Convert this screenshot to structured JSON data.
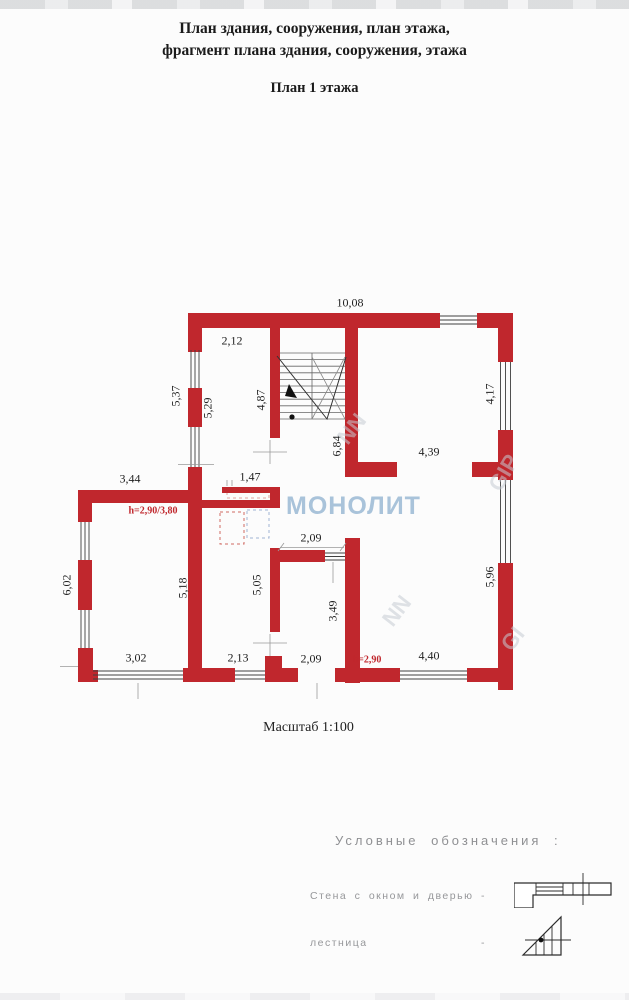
{
  "title": {
    "line1": "План здания, сооружения, план этажа,",
    "line2": "фрагмент плана здания, сооружения, этажа",
    "line3": "План 1 этажа"
  },
  "scale_label": "Масштаб 1:100",
  "watermark": {
    "main": "МОНОЛИТ",
    "color": "#a9c3da",
    "fragments": [
      {
        "text": "NN",
        "x": 352,
        "y": 429,
        "rot": -52
      },
      {
        "text": "NN",
        "x": 397,
        "y": 611,
        "rot": -52
      },
      {
        "text": "GIP",
        "x": 504,
        "y": 473,
        "rot": -60
      },
      {
        "text": "GI",
        "x": 513,
        "y": 639,
        "rot": -52
      }
    ]
  },
  "plan": {
    "wall_color": "#c0272d",
    "dimensions": [
      {
        "text": "10,08",
        "x": 350,
        "y": 303
      },
      {
        "text": "2,12",
        "x": 232,
        "y": 341
      },
      {
        "text": "5,37",
        "x": 176,
        "y": 396,
        "rot": -90
      },
      {
        "text": "5,29",
        "x": 208,
        "y": 408,
        "rot": -90
      },
      {
        "text": "4,87",
        "x": 261,
        "y": 400,
        "rot": -90
      },
      {
        "text": "6,84",
        "x": 337,
        "y": 446,
        "rot": -90
      },
      {
        "text": "4,17",
        "x": 490,
        "y": 394,
        "rot": -90
      },
      {
        "text": "4,39",
        "x": 429,
        "y": 452
      },
      {
        "text": "3,44",
        "x": 130,
        "y": 479
      },
      {
        "text": "1,47",
        "x": 250,
        "y": 477
      },
      {
        "text": "h=2,90/3,80",
        "x": 153,
        "y": 511,
        "red": true
      },
      {
        "text": "2,09",
        "x": 311,
        "y": 538
      },
      {
        "text": "6,02",
        "x": 67,
        "y": 585,
        "rot": -90
      },
      {
        "text": "5,18",
        "x": 183,
        "y": 588,
        "rot": -90
      },
      {
        "text": "5,05",
        "x": 257,
        "y": 585,
        "rot": -90
      },
      {
        "text": "3,49",
        "x": 333,
        "y": 611,
        "rot": -90
      },
      {
        "text": "5,96",
        "x": 490,
        "y": 577,
        "rot": -90
      },
      {
        "text": "3,02",
        "x": 136,
        "y": 658
      },
      {
        "text": "2,13",
        "x": 238,
        "y": 658
      },
      {
        "text": "2,09",
        "x": 311,
        "y": 659
      },
      {
        "text": "h=2,90",
        "x": 367,
        "y": 660,
        "red": true
      },
      {
        "text": "4,40",
        "x": 429,
        "y": 656
      }
    ]
  },
  "legend": {
    "title": "Условные обозначения :",
    "items": [
      {
        "label": "Стена с окном и дверью",
        "sep": "-",
        "symbol": "wall-with-window-and-door"
      },
      {
        "label": "лестница",
        "sep": "-",
        "symbol": "staircase"
      }
    ]
  }
}
